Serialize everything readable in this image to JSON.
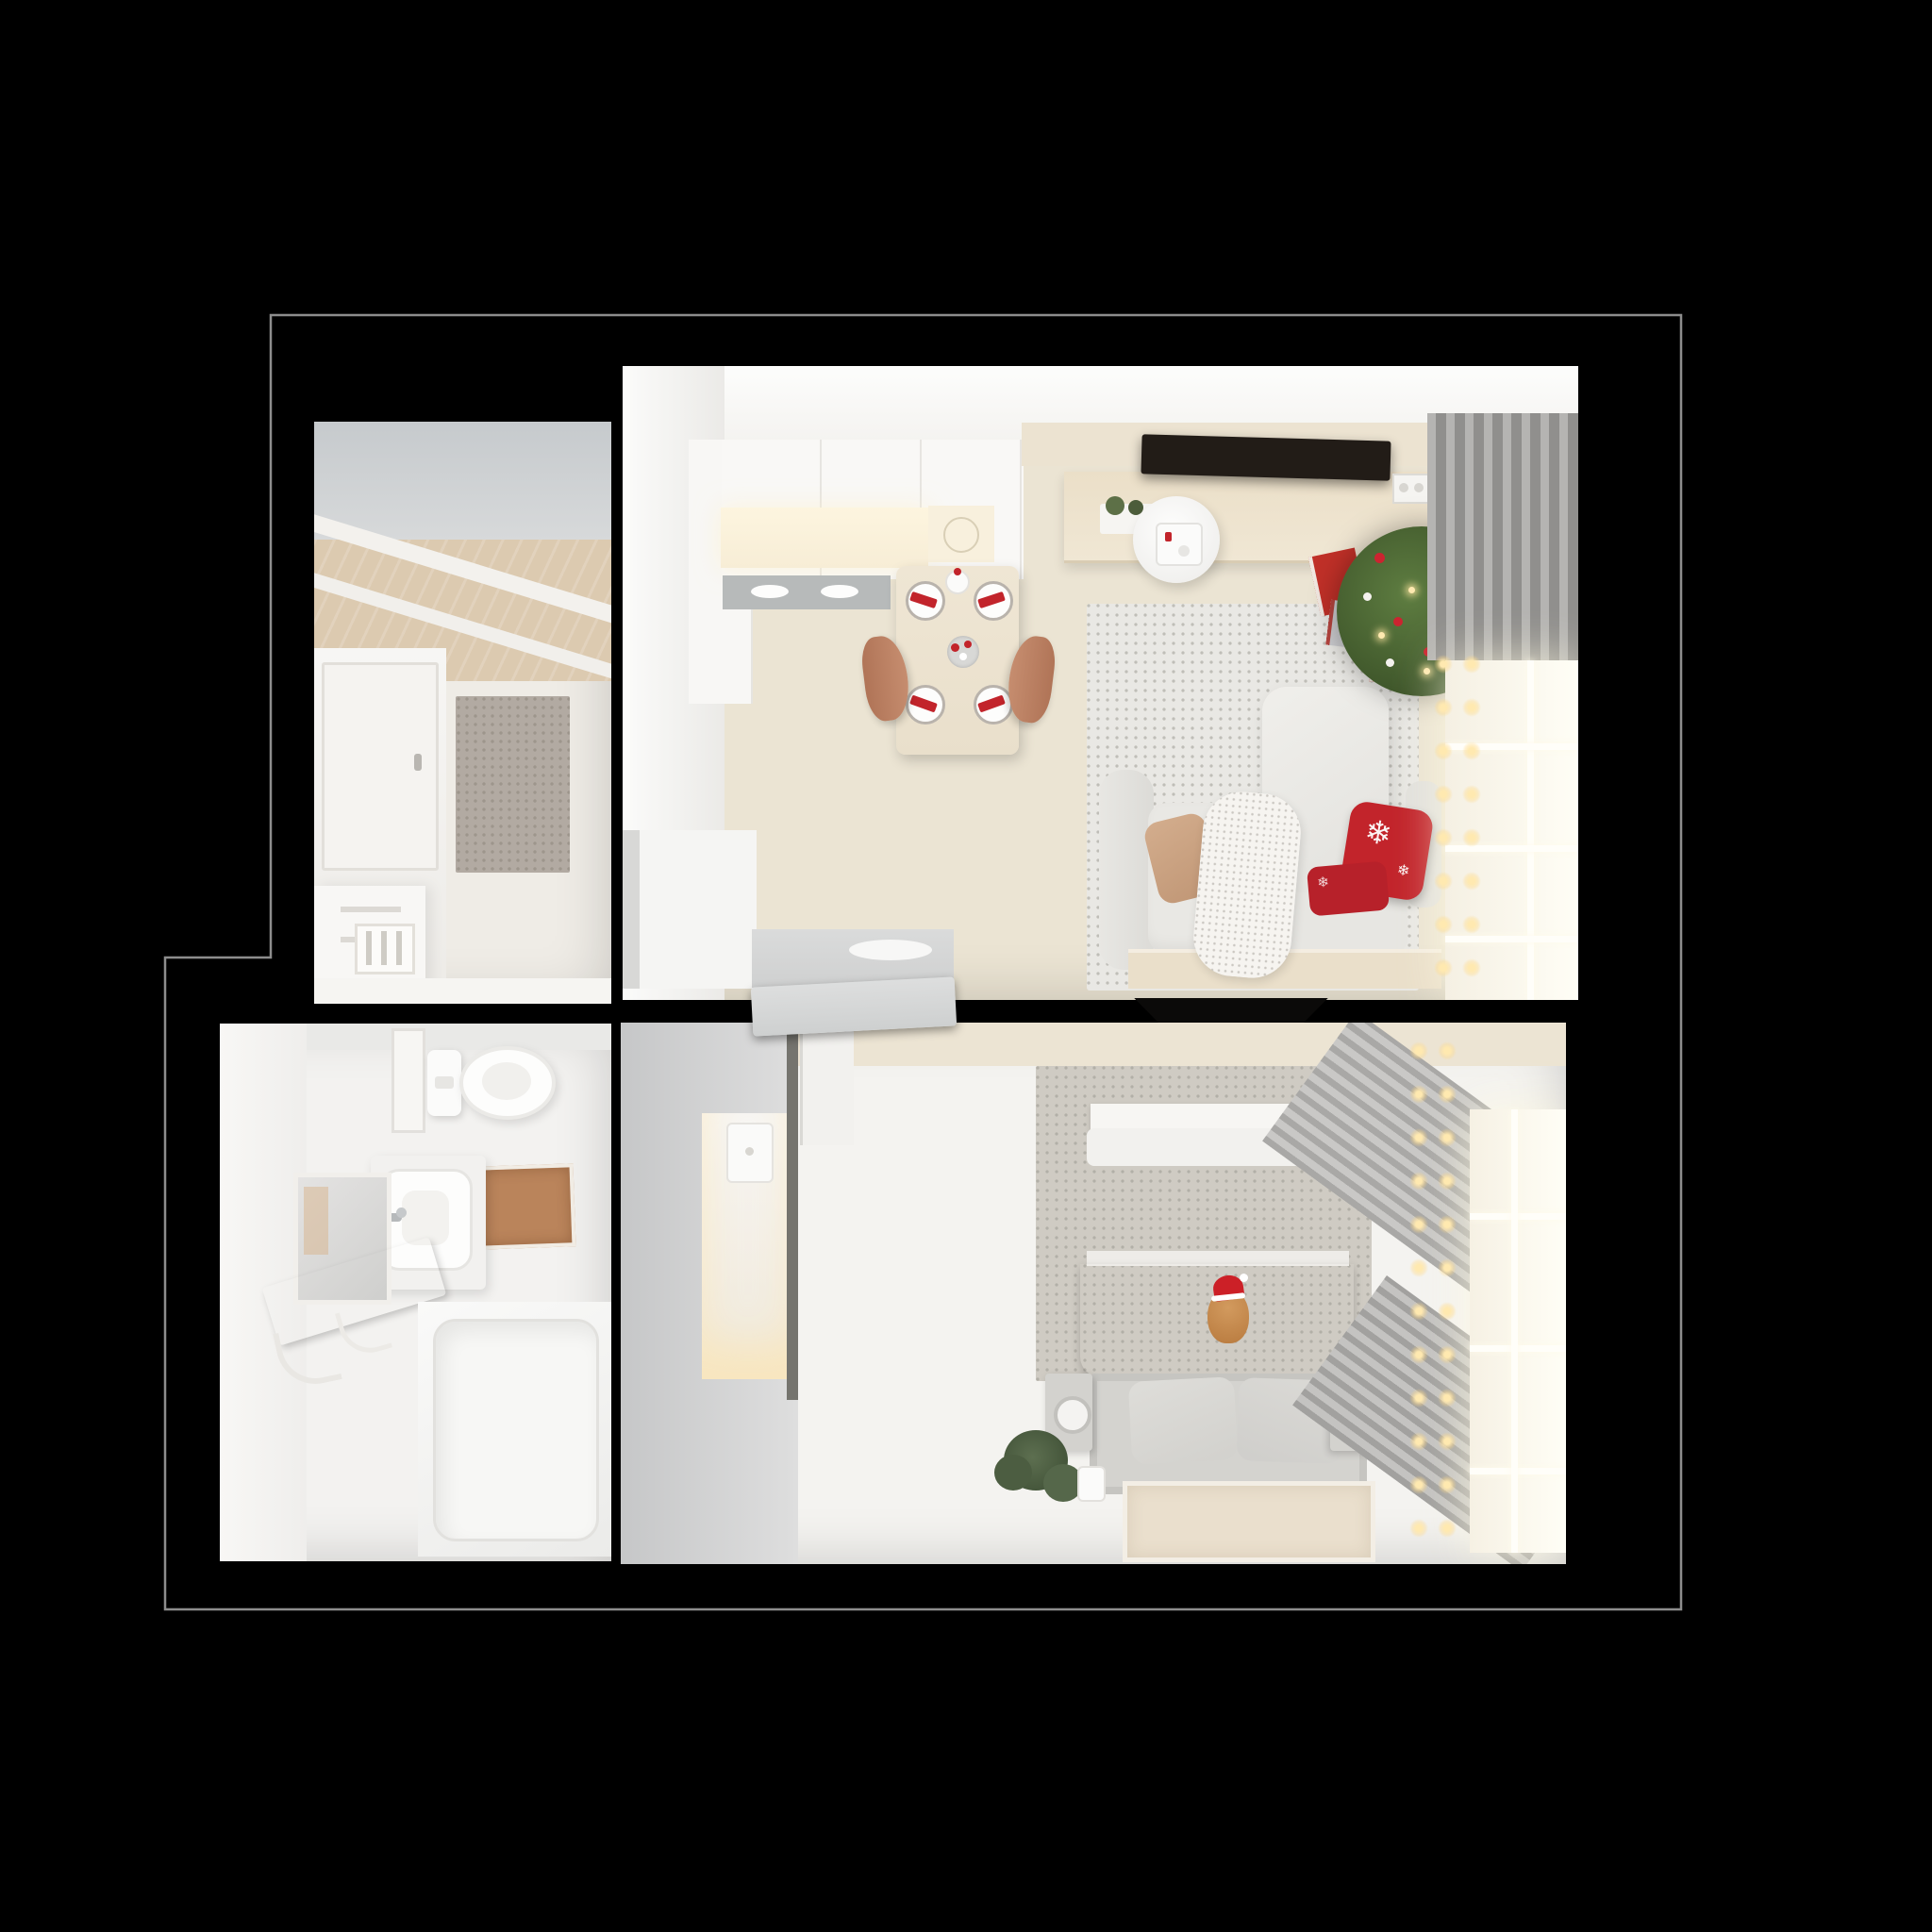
{
  "scene": {
    "type": "3d-floor-plan-top-view",
    "description": "photorealistic top-down render of a one-bedroom apartment with christmas decor on black background",
    "background_color": "#000000",
    "wall_color": "#000000",
    "outline_color": "#8d8d8d"
  },
  "icons": {
    "snowflake": "❄"
  },
  "palette": {
    "wall_white": "#f6f5f2",
    "wall_gray_band": "#ccd0d3",
    "wood_ceiling": "#dccab0",
    "floor_beige": "#ebe4d3",
    "floor_white": "#f4f3f0",
    "tile_gray": "#d8d8d6",
    "hall_rug_gray": "#b2aaa2",
    "living_rug": "#e9e8e4",
    "bedroom_rug_gray": "#cfcbc3",
    "bedroom_rug_beige": "#eadfcd",
    "bath_mat_brown": "#ba845b",
    "woven_tan": "#d2a276",
    "sofa_white": "#e9e8e4",
    "pillow_tan": "#c9a183",
    "christmas_red": "#c2242b",
    "plaid_red": "#7a1e24",
    "blanket_camel": "#d2a47c",
    "tree_green": "#41592c",
    "gift_red": "#c03028",
    "gift_silver": "#cccccf",
    "sideboard_wood": "#ebdfc8",
    "curtain_gray": "#9e9d9b",
    "window_glow": "#fffef6",
    "string_light_warm": "#ffe9b0",
    "chair_terracotta": "#bc8164",
    "tv_black": "#16120e",
    "counter_glow": "#fdf5df"
  },
  "rooms": {
    "hallway": {
      "label": "entrance hall",
      "items": [
        "gray wall band",
        "wood ceiling with beams",
        "white door",
        "gray textured rug",
        "white dresser",
        "slatted vent panel"
      ]
    },
    "bathroom": {
      "label": "bathroom",
      "items": [
        "toilet",
        "washbasin with faucet",
        "mirror",
        "brown bath mat",
        "woven drying rack",
        "bathtub",
        "gray tile floor"
      ]
    },
    "living": {
      "label": "kitchen and living room",
      "items": [
        "white kitchen cabinets",
        "lit counter",
        "cooktop",
        "dining table with red place settings",
        "two terracotta chairs",
        "wood tv sideboard",
        "wall tv",
        "white area rug",
        "round side table with thermostat",
        "white sofa",
        "tan pillow",
        "knit throw",
        "red snowflake pillows",
        "christmas tree with ornaments",
        "gift boxes",
        "gray curtains",
        "window with string lights"
      ]
    },
    "bedroom": {
      "label": "bedroom",
      "items": [
        "wardrobe with lit niche",
        "open door",
        "wall tv",
        "gray rug",
        "bed with camel blanket",
        "red plaid blanket",
        "plush toy with santa hat",
        "foot bench with pillows",
        "two speakers",
        "green plant",
        "mug",
        "beige rug",
        "gray curtains",
        "window with string lights"
      ]
    }
  },
  "counts": {
    "dining_place_settings": 4,
    "sofa_red_pillows": 2,
    "bench_pillows": 2,
    "speakers": 2,
    "gift_boxes": 4
  }
}
